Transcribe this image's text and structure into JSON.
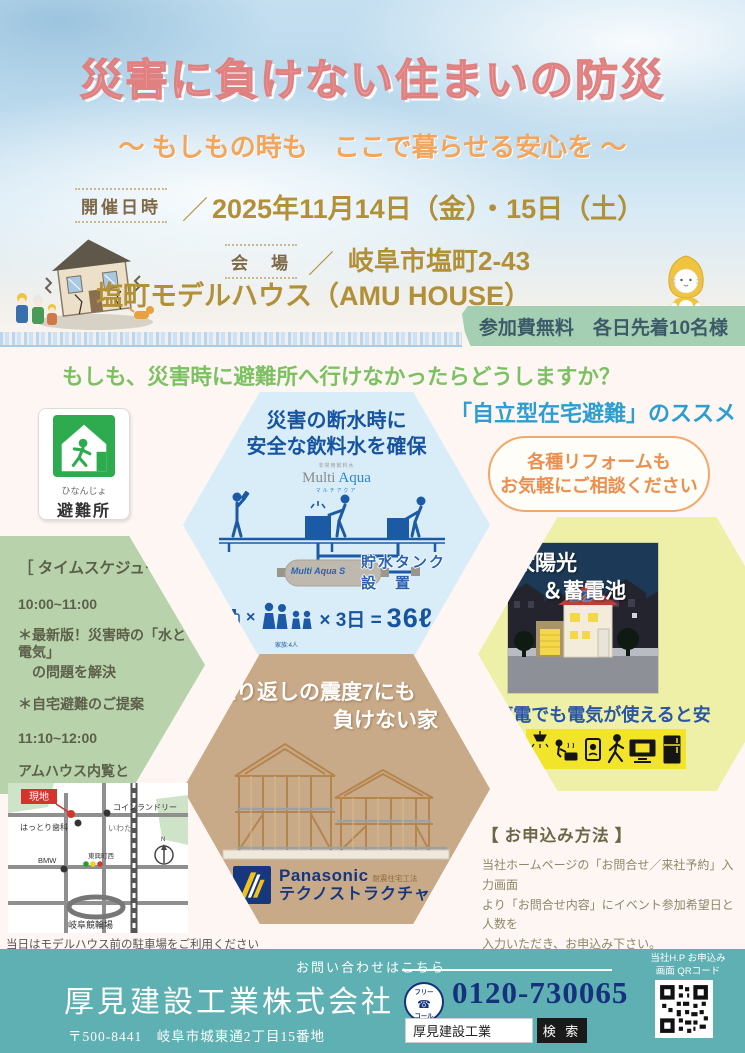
{
  "colors": {
    "title_pink": "#f0a3a3",
    "subtitle_orange": "#f3a55b",
    "gold": "#b19038",
    "fee_band_green": "#a5cfb2",
    "question_green": "#7cc161",
    "recommend_blue": "#2d9ecf",
    "hex_water": "#d9edf8",
    "hex_schedule": "#b8d2ab",
    "hex_solar": "#eff0a8",
    "hex_house": "#c9aa88",
    "footer_teal": "#5fb0b2",
    "phone_navy": "#16327e"
  },
  "header": {
    "title": "災害に負けない住まいの防災",
    "subtitle": "～ もしもの時も　ここで暮らせる安心を ～",
    "date_label": "開催日時",
    "slash1": "／",
    "date": "2025年11月14日（金）・15日（土）",
    "venue_label": "会　場",
    "slash2": "／",
    "venue_address": "岐阜市塩町2-43",
    "venue_name": "塩町モデルハウス（AMU HOUSE）",
    "fee_banner": "参加費無料　各日先着10名様"
  },
  "intro": {
    "question": "もしも、災害時に避難所へ行けなかったらどうしますか？",
    "recommend": "「自立型在宅避難」のススメ",
    "shelter_furigana": "ひなんじょ",
    "shelter_label": "避難所"
  },
  "water": {
    "heading1": "災害の断水時に",
    "heading2": "安全な飲料水を確保",
    "brand_ruby": "非常用飲料水",
    "brand_gray": "Multi ",
    "brand_blue": "Aqua",
    "brand_sub": "マルチアクア",
    "tank_label": "Multi Aqua S",
    "tank_caption1": "貯水タンク",
    "tank_caption2": "設　置",
    "note_bottle": "飲料水:1日に3ℓ",
    "note_family": "家族:4人",
    "formula_mult": "×",
    "formula_mid": "× 3日 =",
    "formula_total": "36ℓ"
  },
  "bubble": {
    "line1": "各種リフォームも",
    "line2": "お気軽にご相談ください"
  },
  "schedule": {
    "title": "［ タイムスケジュール ］",
    "items": [
      "10:00~11:00",
      "＊最新版！災害時の「水と電気」",
      "　の問題を解決",
      "＊自宅避難のご提案",
      "11:10~12:00",
      "アムハウス内覧と",
      "　　各種住まいのご相談"
    ]
  },
  "solar": {
    "img_title1": "太陽光",
    "img_title2": "＆蓄電池",
    "caption": "停電でも電気が使えると安心！"
  },
  "house": {
    "heading1": "繰り返しの震度7にも",
    "heading2": "負けない家",
    "brand": "Panasonic",
    "brand_note": "耐震住宅工法",
    "brand_product": "テクノストラクチャー"
  },
  "map": {
    "site": "現地",
    "coin_laundry": "コインランドリー",
    "dental": "はっとり歯科",
    "iwata": "いわた",
    "bmw": "BMW",
    "intersection": "東興町西",
    "keirin": "岐阜競輪場",
    "compass_n": "N",
    "note": "当日はモデルハウス前の駐車場をご利用ください"
  },
  "apply": {
    "heading": "【 お申込み方法 】",
    "lines": [
      "当社ホームページの「お問合せ／来社予約」入力画面",
      "より「お問合せ内容」にイベント参加希望日と人数を",
      "入力いただき、お申込み下さい。",
      "＊ 定員に達し次第、締め切りとなります"
    ]
  },
  "footer": {
    "contact": "お問い合わせはこちら",
    "company": "厚見建設工業株式会社",
    "address": "〒500-8441　岐阜市城東通2丁目15番地",
    "free_call1": "フリー",
    "free_call2": "コール",
    "phone": "0120-730065",
    "search_value": "厚見建設工業",
    "search_button": "検 索",
    "qr_caption1": "当社H.P お申込み",
    "qr_caption2": "画面 QRコード"
  }
}
